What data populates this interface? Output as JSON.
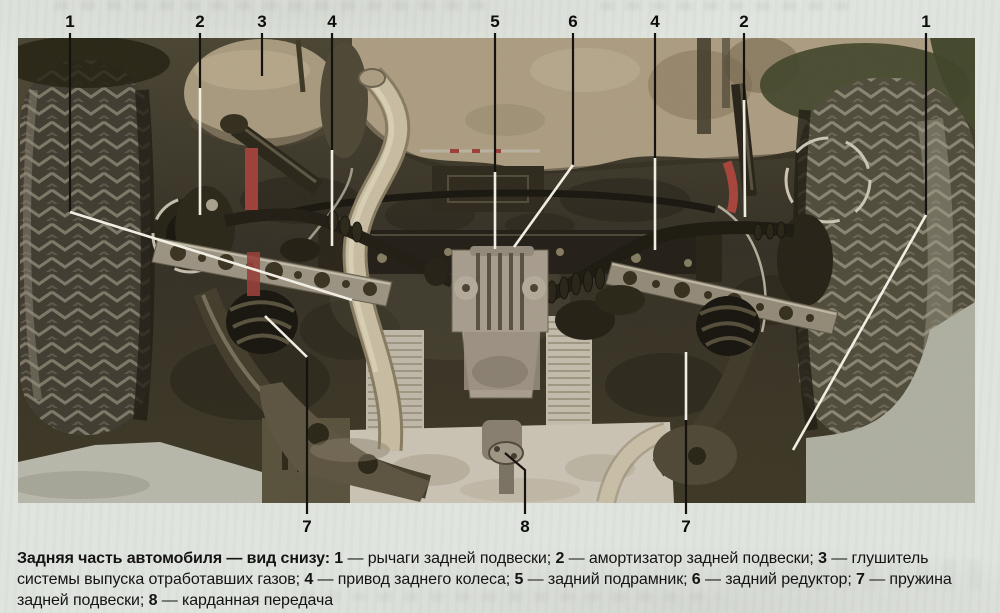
{
  "figure": {
    "kind": "labelled manual photo",
    "photo_area": {
      "x": 18,
      "y": 38,
      "w": 957,
      "h": 465
    }
  },
  "palette": {
    "page_bg": "#e0e4de",
    "photo_dark": "#332e1f",
    "underbody_tan": "#b6a78a",
    "pipe_cream": "#d7cbb0",
    "shield_light": "#d9d3c5",
    "metal_silver": "#a39b8b",
    "accent_red": "#a83c36",
    "leader_black": "#151310",
    "leader_white": "#f0ede2",
    "label_color": "#0d0d0d"
  },
  "callouts": [
    {
      "label": "1",
      "x": 70,
      "y": 27,
      "pos": "top",
      "segs": [
        {
          "c": "#151310",
          "p": [
            [
              70,
              33
            ],
            [
              70,
              212
            ]
          ]
        },
        {
          "c": "#f0ede2",
          "p": [
            [
              70,
              212
            ],
            [
              352,
              300
            ]
          ]
        }
      ]
    },
    {
      "label": "2",
      "x": 200,
      "y": 27,
      "pos": "top",
      "segs": [
        {
          "c": "#151310",
          "p": [
            [
              200,
              33
            ],
            [
              200,
              88
            ]
          ]
        },
        {
          "c": "#f0ede2",
          "p": [
            [
              200,
              88
            ],
            [
              200,
              215
            ]
          ]
        }
      ]
    },
    {
      "label": "3",
      "x": 262,
      "y": 27,
      "pos": "top",
      "segs": [
        {
          "c": "#151310",
          "p": [
            [
              262,
              33
            ],
            [
              262,
              76
            ]
          ]
        }
      ]
    },
    {
      "label": "4",
      "x": 332,
      "y": 27,
      "pos": "top",
      "segs": [
        {
          "c": "#151310",
          "p": [
            [
              332,
              33
            ],
            [
              332,
              150
            ]
          ]
        },
        {
          "c": "#f0ede2",
          "p": [
            [
              332,
              150
            ],
            [
              332,
              246
            ]
          ]
        }
      ]
    },
    {
      "label": "5",
      "x": 495,
      "y": 27,
      "pos": "top",
      "segs": [
        {
          "c": "#151310",
          "p": [
            [
              495,
              33
            ],
            [
              495,
              172
            ]
          ]
        },
        {
          "c": "#f0ede2",
          "p": [
            [
              495,
              172
            ],
            [
              495,
              249
            ]
          ]
        }
      ]
    },
    {
      "label": "6",
      "x": 573,
      "y": 27,
      "pos": "top",
      "segs": [
        {
          "c": "#151310",
          "p": [
            [
              573,
              33
            ],
            [
              573,
              165
            ]
          ]
        },
        {
          "c": "#f0ede2",
          "p": [
            [
              573,
              165
            ],
            [
              514,
              247
            ]
          ]
        }
      ]
    },
    {
      "label": "4",
      "x": 655,
      "y": 27,
      "pos": "top",
      "segs": [
        {
          "c": "#151310",
          "p": [
            [
              655,
              33
            ],
            [
              655,
              158
            ]
          ]
        },
        {
          "c": "#f0ede2",
          "p": [
            [
              655,
              158
            ],
            [
              655,
              250
            ]
          ]
        }
      ]
    },
    {
      "label": "2",
      "x": 744,
      "y": 27,
      "pos": "top",
      "segs": [
        {
          "c": "#151310",
          "p": [
            [
              744,
              33
            ],
            [
              744,
              100
            ]
          ]
        },
        {
          "c": "#f0ede2",
          "p": [
            [
              744,
              100
            ],
            [
              745,
              217
            ]
          ]
        }
      ]
    },
    {
      "label": "1",
      "x": 926,
      "y": 27,
      "pos": "top",
      "segs": [
        {
          "c": "#151310",
          "p": [
            [
              926,
              33
            ],
            [
              926,
              215
            ]
          ]
        },
        {
          "c": "#f0ede2",
          "p": [
            [
              926,
              215
            ],
            [
              793,
              450
            ]
          ]
        }
      ]
    },
    {
      "label": "7",
      "x": 307,
      "y": 532,
      "pos": "bottom",
      "segs": [
        {
          "c": "#151310",
          "p": [
            [
              307,
              514
            ],
            [
              307,
              357
            ]
          ]
        },
        {
          "c": "#f0ede2",
          "p": [
            [
              307,
              357
            ],
            [
              265,
              316
            ]
          ]
        }
      ]
    },
    {
      "label": "8",
      "x": 525,
      "y": 532,
      "pos": "bottom",
      "segs": [
        {
          "c": "#151310",
          "p": [
            [
              525,
              514
            ],
            [
              525,
              470
            ],
            [
              505,
              453
            ]
          ]
        }
      ]
    },
    {
      "label": "7",
      "x": 686,
      "y": 532,
      "pos": "bottom",
      "segs": [
        {
          "c": "#151310",
          "p": [
            [
              686,
              514
            ],
            [
              686,
              420
            ]
          ]
        },
        {
          "c": "#f0ede2",
          "p": [
            [
              686,
              420
            ],
            [
              686,
              352
            ]
          ]
        }
      ]
    }
  ],
  "caption": {
    "intro": "Задняя часть автомобиля — вид снизу:",
    "items": [
      {
        "num": "1",
        "text": " — рычаги задней подвески; "
      },
      {
        "num": "2",
        "text": " — амортизатор задней подвески; "
      },
      {
        "num": "3",
        "text": " — глушитель системы выпуска отработавших газов; "
      },
      {
        "num": "4",
        "text": " — привод заднего колеса; "
      },
      {
        "num": "5",
        "text": " — задний подрамник; "
      },
      {
        "num": "6",
        "text": " — задний редуктор; "
      },
      {
        "num": "7",
        "text": " — пружина задней подвески; "
      },
      {
        "num": "8",
        "text": " — карданная передача"
      }
    ]
  }
}
